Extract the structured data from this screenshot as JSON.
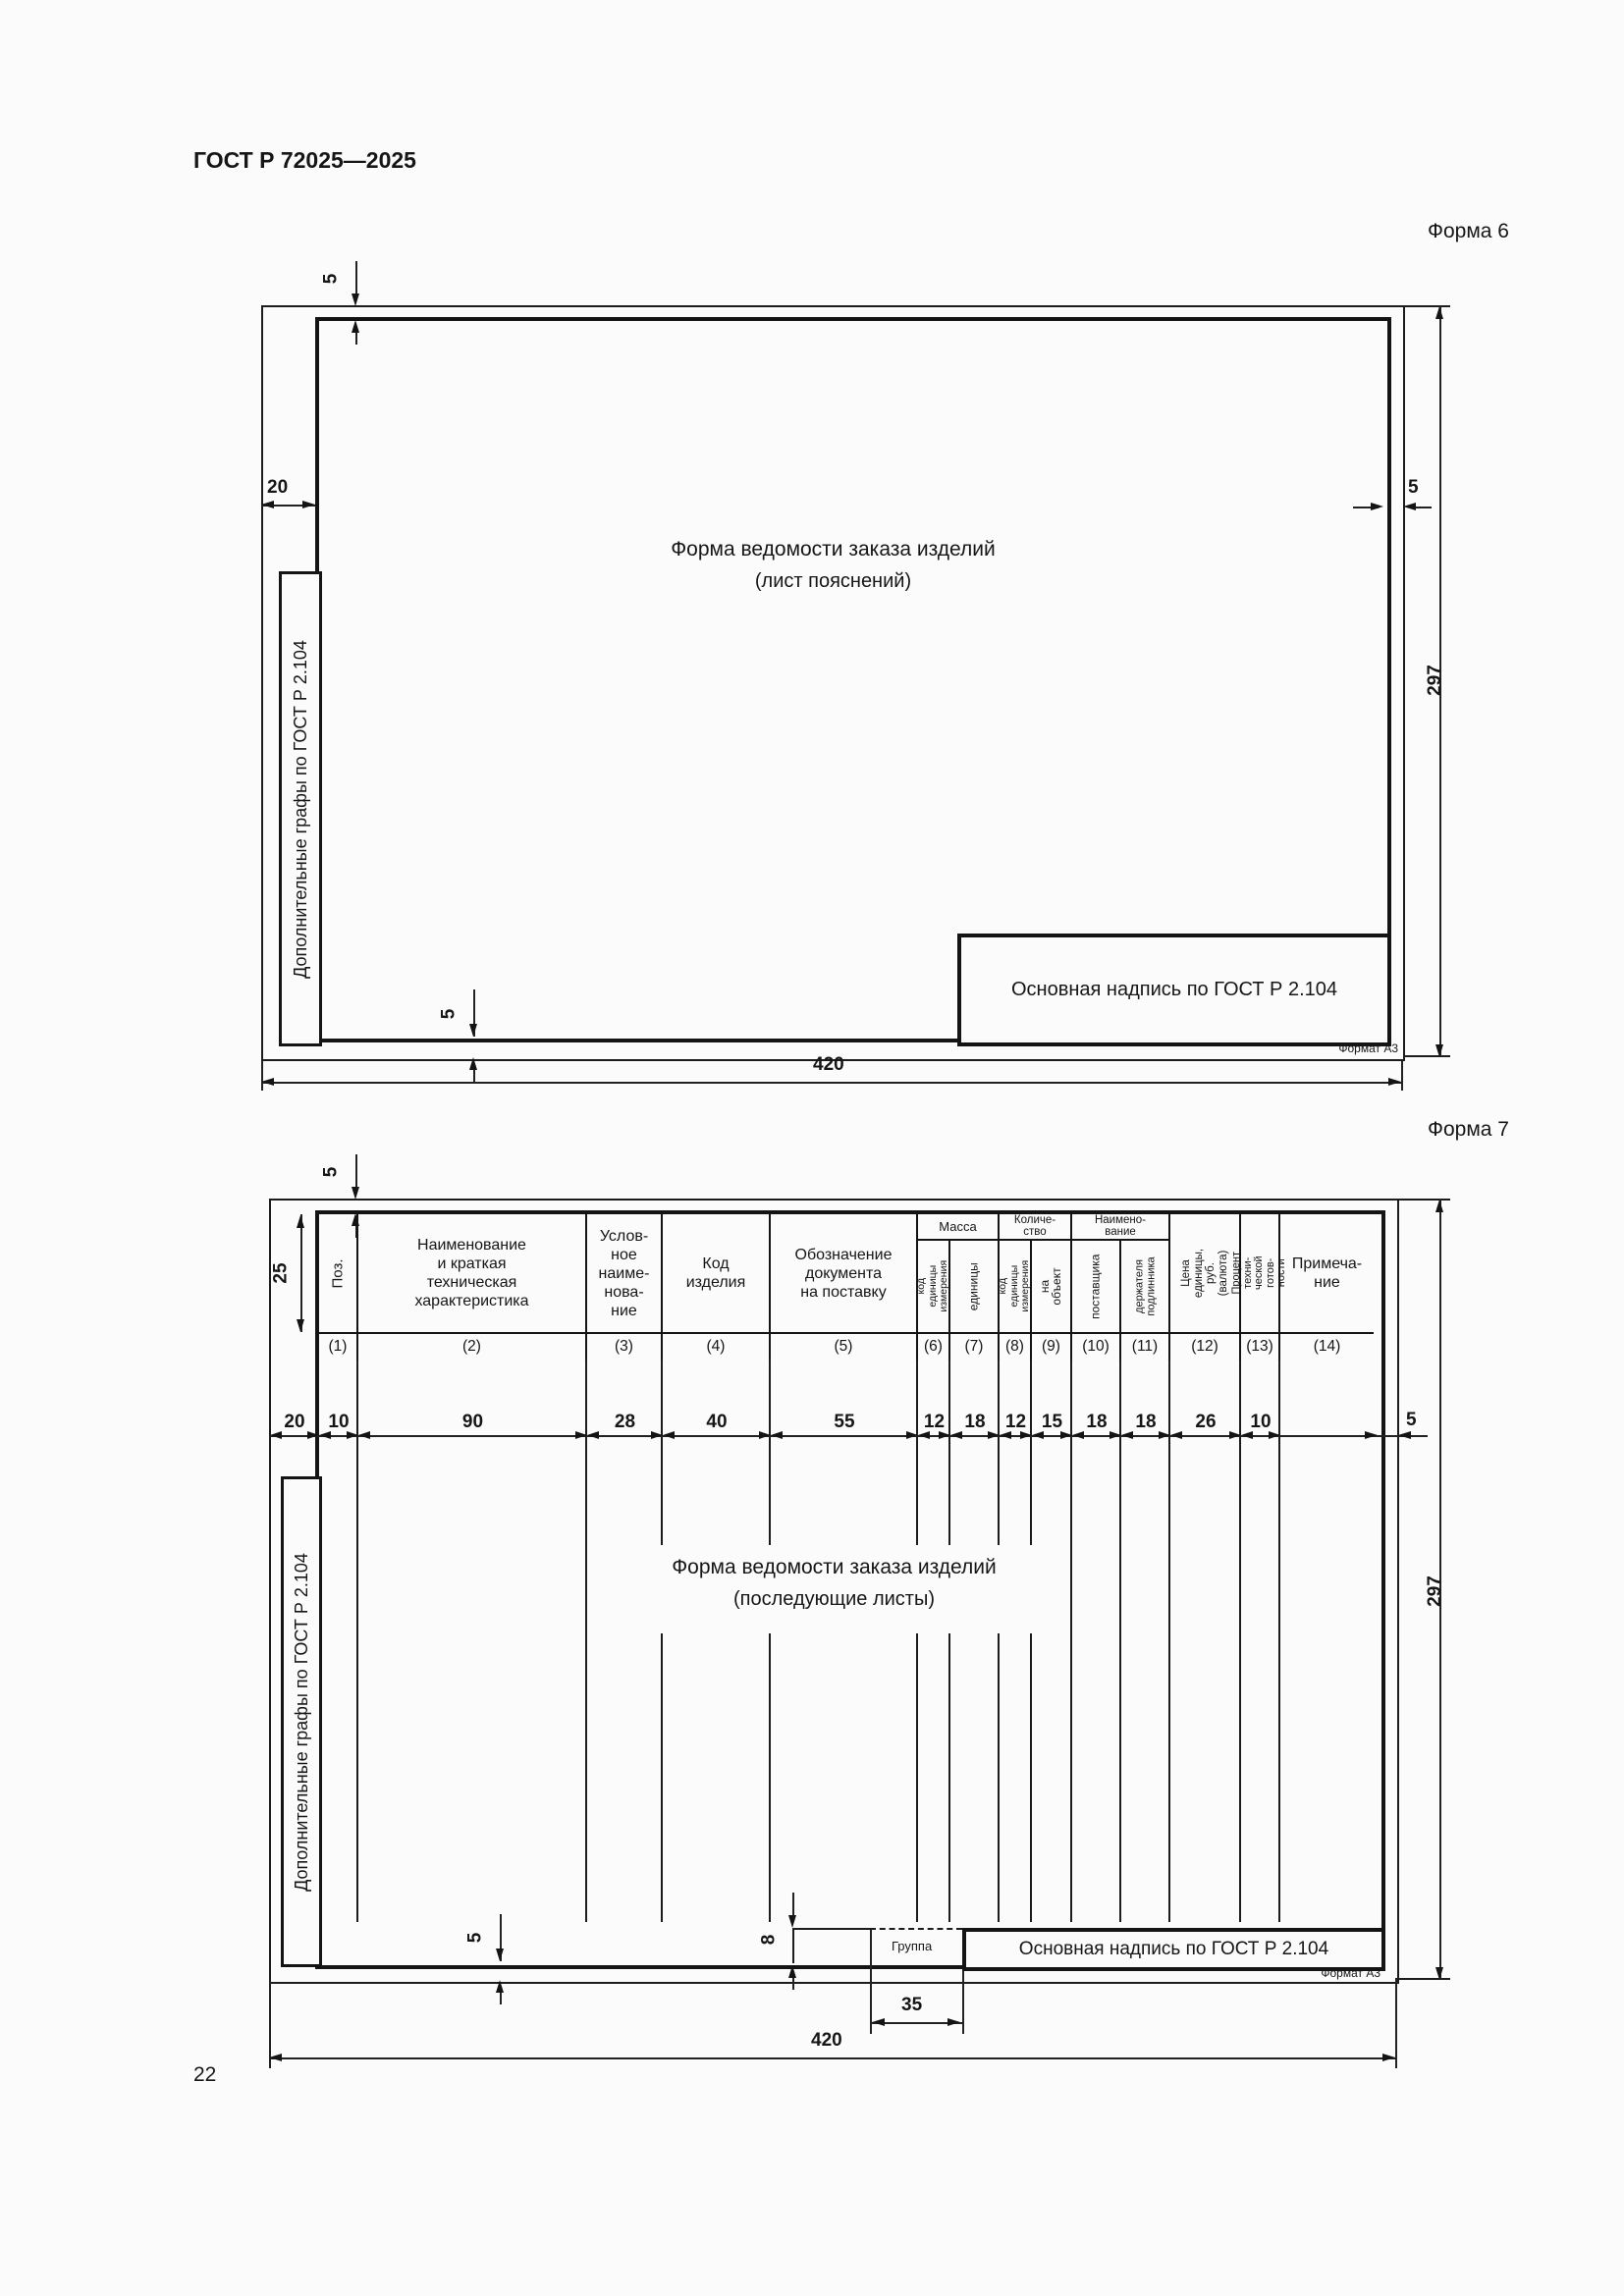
{
  "page": {
    "doc_code": "ГОСТ Р 72025—2025",
    "page_number": "22"
  },
  "form6": {
    "label": "Форма 6",
    "center_line1": "Форма ведомости заказа изделий",
    "center_line2": "(лист пояснений)",
    "side_box_label": "Дополнительные графы по ГОСТ Р 2.104",
    "title_block_label": "Основная надпись по ГОСТ Р 2.104",
    "format_label": "Формат А3",
    "dims": {
      "top_gap": "5",
      "left_margin": "20",
      "right_gap": "5",
      "bottom_gap": "5",
      "sheet_height": "297",
      "sheet_width": "420"
    }
  },
  "form7": {
    "label": "Форма 7",
    "center_line1": "Форма ведомости заказа изделий",
    "center_line2": "(последующие листы)",
    "side_box_label": "Дополнительные графы по ГОСТ Р 2.104",
    "title_block_label": "Основная надпись по ГОСТ Р 2.104",
    "format_label": "Формат А3",
    "group_cell_label": "Группа",
    "groups": [
      "Масса",
      "Количе-\nство",
      "Наимено-\nвание"
    ],
    "columns": [
      {
        "num": "(1)",
        "label": "Поз."
      },
      {
        "num": "(2)",
        "label": "Наименование\nи краткая\nтехническая\nхарактеристика"
      },
      {
        "num": "(3)",
        "label": "Услов-\nное\nнаиме-\nнова-\nние"
      },
      {
        "num": "(4)",
        "label": "Код\nизделия"
      },
      {
        "num": "(5)",
        "label": "Обозначение\nдокумента\nна поставку"
      },
      {
        "num": "(6)",
        "label": "код единицы\nизмерения"
      },
      {
        "num": "(7)",
        "label": "единицы"
      },
      {
        "num": "(8)",
        "label": "код единицы\nизмерения"
      },
      {
        "num": "(9)",
        "label": "на объект"
      },
      {
        "num": "(10)",
        "label": "поставщика"
      },
      {
        "num": "(11)",
        "label": "держателя\nподлинника"
      },
      {
        "num": "(12)",
        "label": "Цена\nединицы, руб.\n(валюта)"
      },
      {
        "num": "(13)",
        "label": "Процент техни-\nческой готов-\nности"
      },
      {
        "num": "(14)",
        "label": "Примеча-\nние"
      }
    ],
    "dim_row": [
      "20",
      "10",
      "90",
      "28",
      "40",
      "55",
      "12",
      "18",
      "12",
      "15",
      "18",
      "18",
      "26",
      "10"
    ],
    "dims": {
      "top_gap": "5",
      "header_height": "25",
      "right_gap": "5",
      "bottom_gap": "5",
      "sheet_height": "297",
      "sheet_width": "420",
      "group_width": "35",
      "group_height": "8"
    }
  }
}
